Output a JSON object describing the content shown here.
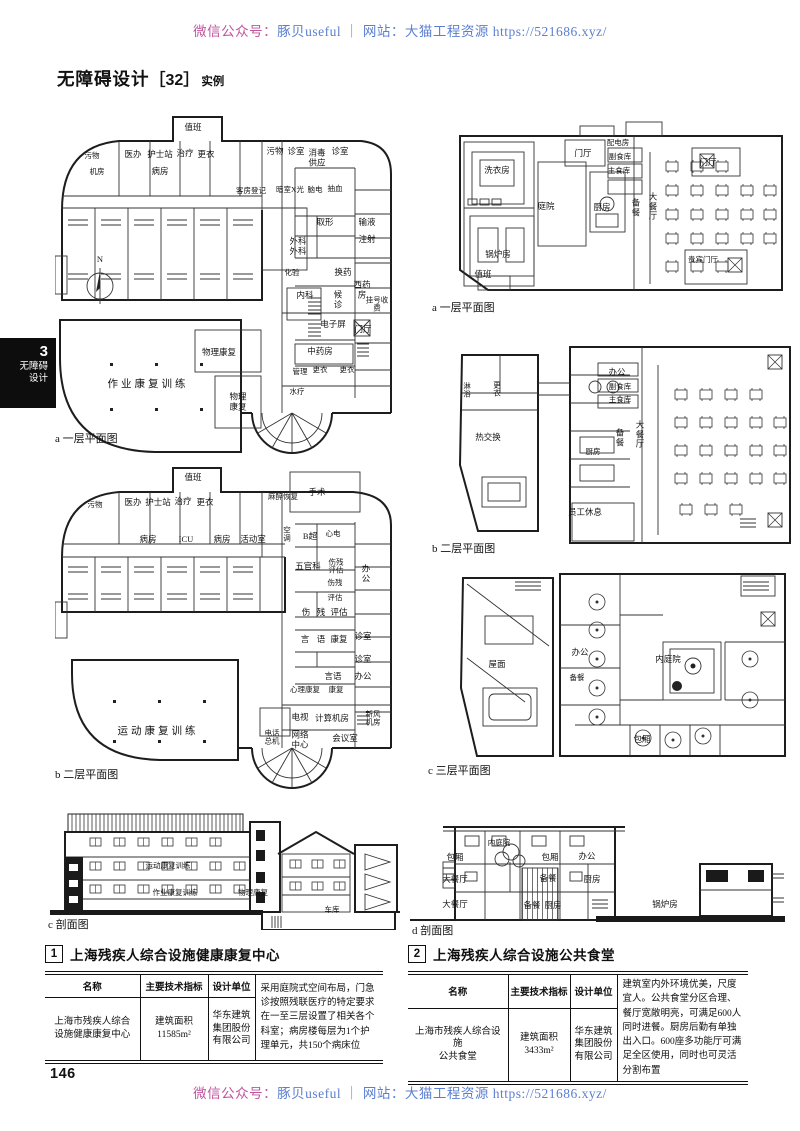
{
  "watermark": {
    "wechat_label": "微信公众号：",
    "wechat_name": "豚贝useful",
    "divider": "｜",
    "site_text": "网站：大猫工程资源 https://521686.xyz/",
    "magenta": "#c0559e",
    "blue": "#5b7fd0"
  },
  "title": {
    "main": "无障碍设计",
    "bracket": "［32］",
    "suffix": "实例"
  },
  "sidebar_tab": {
    "number": "3",
    "line1": "无障碍",
    "line2": "设计"
  },
  "page_number": "146",
  "figures": {
    "plan_a_left": {
      "caption": "a 一层平面图",
      "labels": [
        {
          "t": "值班",
          "x": 138,
          "y": 20
        },
        {
          "t": "污物",
          "x": 37,
          "y": 48,
          "s": 1
        },
        {
          "t": "机房",
          "x": 42,
          "y": 64,
          "s": 1
        },
        {
          "t": "医办",
          "x": 78,
          "y": 47
        },
        {
          "t": "护士站",
          "x": 105,
          "y": 47
        },
        {
          "t": "治疗",
          "x": 130,
          "y": 46
        },
        {
          "t": "更衣",
          "x": 151,
          "y": 47
        },
        {
          "t": "病房",
          "x": 105,
          "y": 64
        },
        {
          "t": "污物",
          "x": 220,
          "y": 44
        },
        {
          "t": "诊室",
          "x": 241,
          "y": 44
        },
        {
          "t": "消毒\n供应",
          "x": 262,
          "y": 50
        },
        {
          "t": "诊室",
          "x": 285,
          "y": 44
        },
        {
          "t": "客房登记",
          "x": 196,
          "y": 83,
          "s": 1
        },
        {
          "t": "暗室X光",
          "x": 235,
          "y": 82,
          "s": 1
        },
        {
          "t": "脑电",
          "x": 260,
          "y": 82,
          "s": 1
        },
        {
          "t": "抽血",
          "x": 280,
          "y": 81,
          "s": 1
        },
        {
          "t": "取形",
          "x": 270,
          "y": 115
        },
        {
          "t": "输液",
          "x": 312,
          "y": 115
        },
        {
          "t": "注射",
          "x": 312,
          "y": 132
        },
        {
          "t": "外科",
          "x": 243,
          "y": 134
        },
        {
          "t": "外科",
          "x": 243,
          "y": 144
        },
        {
          "t": "化验",
          "x": 237,
          "y": 165,
          "s": 1
        },
        {
          "t": "换药",
          "x": 288,
          "y": 165
        },
        {
          "t": "西药\n房",
          "x": 307,
          "y": 182
        },
        {
          "t": "挂号收费",
          "x": 322,
          "y": 197,
          "s": 1
        },
        {
          "t": "内科",
          "x": 250,
          "y": 188
        },
        {
          "t": "候\n诊",
          "x": 283,
          "y": 192
        },
        {
          "t": "电子屏",
          "x": 278,
          "y": 217
        },
        {
          "t": "门厅",
          "x": 308,
          "y": 222
        },
        {
          "t": "中药房",
          "x": 265,
          "y": 244
        },
        {
          "t": "管理",
          "x": 245,
          "y": 264,
          "s": 1
        },
        {
          "t": "更衣",
          "x": 265,
          "y": 262,
          "s": 1
        },
        {
          "t": "更衣",
          "x": 292,
          "y": 262,
          "s": 1
        },
        {
          "t": "水疗",
          "x": 242,
          "y": 284,
          "s": 1
        },
        {
          "t": "作业康复训练",
          "x": 93,
          "y": 277,
          "b": 1
        },
        {
          "t": "物理康复",
          "x": 164,
          "y": 245
        },
        {
          "t": "物理\n康复",
          "x": 183,
          "y": 294
        },
        {
          "t": "N",
          "x": 45,
          "y": 152
        }
      ]
    },
    "plan_b_left": {
      "caption": "b 二层平面图",
      "labels": [
        {
          "t": "值班",
          "x": 138,
          "y": 16
        },
        {
          "t": "污物",
          "x": 40,
          "y": 43,
          "s": 1
        },
        {
          "t": "医办",
          "x": 78,
          "y": 41
        },
        {
          "t": "护士站",
          "x": 103,
          "y": 41
        },
        {
          "t": "治疗",
          "x": 128,
          "y": 40
        },
        {
          "t": "更衣",
          "x": 150,
          "y": 41
        },
        {
          "t": "麻醉恢复",
          "x": 228,
          "y": 35,
          "s": 1
        },
        {
          "t": "手术",
          "x": 262,
          "y": 31
        },
        {
          "t": "病房",
          "x": 93,
          "y": 78
        },
        {
          "t": "ICU",
          "x": 131,
          "y": 78
        },
        {
          "t": "病房",
          "x": 167,
          "y": 78
        },
        {
          "t": "活动室",
          "x": 198,
          "y": 78
        },
        {
          "t": "空\n调",
          "x": 232,
          "y": 73,
          "s": 1
        },
        {
          "t": "B超",
          "x": 255,
          "y": 75
        },
        {
          "t": "心电",
          "x": 278,
          "y": 72,
          "s": 1
        },
        {
          "t": "五官科",
          "x": 253,
          "y": 105
        },
        {
          "t": "伤残\n评估",
          "x": 281,
          "y": 105,
          "s": 1
        },
        {
          "t": "办\n公",
          "x": 311,
          "y": 112
        },
        {
          "t": "伤残",
          "x": 280,
          "y": 121,
          "s": 1
        },
        {
          "t": "评估",
          "x": 280,
          "y": 136,
          "s": 1
        },
        {
          "t": "伤",
          "x": 251,
          "y": 151
        },
        {
          "t": "残",
          "x": 266,
          "y": 151
        },
        {
          "t": "评估",
          "x": 284,
          "y": 151
        },
        {
          "t": "言",
          "x": 250,
          "y": 178
        },
        {
          "t": "语",
          "x": 266,
          "y": 178
        },
        {
          "t": "康复",
          "x": 284,
          "y": 178
        },
        {
          "t": "诊室",
          "x": 308,
          "y": 175
        },
        {
          "t": "诊室",
          "x": 308,
          "y": 198
        },
        {
          "t": "言语",
          "x": 278,
          "y": 215
        },
        {
          "t": "办公",
          "x": 308,
          "y": 215
        },
        {
          "t": "心理康复",
          "x": 250,
          "y": 228,
          "s": 1
        },
        {
          "t": "康复",
          "x": 281,
          "y": 228,
          "s": 1
        },
        {
          "t": "电视",
          "x": 245,
          "y": 256
        },
        {
          "t": "计算机房",
          "x": 277,
          "y": 257
        },
        {
          "t": "新风\n机房",
          "x": 318,
          "y": 257,
          "s": 1
        },
        {
          "t": "电话\n总机",
          "x": 217,
          "y": 276,
          "s": 1
        },
        {
          "t": "网络\n中心",
          "x": 245,
          "y": 278
        },
        {
          "t": "会议室",
          "x": 290,
          "y": 277
        },
        {
          "t": "运动康复训练",
          "x": 103,
          "y": 270,
          "b": 1
        }
      ]
    },
    "section_c": {
      "caption": "c 剖面图",
      "labels": [
        {
          "t": "运动康复训练",
          "x": 118,
          "y": 64,
          "s": 1
        },
        {
          "t": "作业康复训练",
          "x": 125,
          "y": 91,
          "s": 1
        },
        {
          "t": "物理康复",
          "x": 203,
          "y": 91,
          "s": 1
        },
        {
          "t": "车库",
          "x": 282,
          "y": 108,
          "s": 1
        }
      ]
    },
    "plan_a_right": {
      "caption": "a 一层平面图",
      "labels": [
        {
          "t": "洗衣房",
          "x": 67,
          "y": 59
        },
        {
          "t": "庭院",
          "x": 116,
          "y": 95
        },
        {
          "t": "门厅",
          "x": 153,
          "y": 42
        },
        {
          "t": "配电房",
          "x": 188,
          "y": 31,
          "s": 1
        },
        {
          "t": "副食库",
          "x": 190,
          "y": 45,
          "s": 1
        },
        {
          "t": "主食库",
          "x": 189,
          "y": 59,
          "s": 1
        },
        {
          "t": "厨房",
          "x": 172,
          "y": 96
        },
        {
          "t": "备\n餐",
          "x": 206,
          "y": 96
        },
        {
          "t": "大\n餐\n厅",
          "x": 223,
          "y": 95
        },
        {
          "t": "门厅",
          "x": 278,
          "y": 51
        },
        {
          "t": "贵宾门厅",
          "x": 273,
          "y": 148,
          "s": 1
        },
        {
          "t": "锅炉房",
          "x": 68,
          "y": 143
        },
        {
          "t": "值班",
          "x": 53,
          "y": 163
        }
      ]
    },
    "plan_b_right": {
      "caption": "b 二层平面图",
      "labels": [
        {
          "t": "淋\n浴",
          "x": 37,
          "y": 56,
          "s": 1
        },
        {
          "t": "更\n衣",
          "x": 67,
          "y": 55,
          "s": 1
        },
        {
          "t": "热交换",
          "x": 58,
          "y": 103
        },
        {
          "t": "办公",
          "x": 187,
          "y": 38
        },
        {
          "t": "副食库",
          "x": 190,
          "y": 52,
          "s": 1
        },
        {
          "t": "主食库",
          "x": 190,
          "y": 65,
          "s": 1
        },
        {
          "t": "备\n餐",
          "x": 190,
          "y": 103
        },
        {
          "t": "大\n餐\n厅",
          "x": 210,
          "y": 100
        },
        {
          "t": "厨房",
          "x": 163,
          "y": 117,
          "s": 1
        },
        {
          "t": "员工休息",
          "x": 155,
          "y": 178
        }
      ]
    },
    "plan_c_right": {
      "caption": "c 三层平面图",
      "labels": [
        {
          "t": "屋面",
          "x": 72,
          "y": 105
        },
        {
          "t": "办公",
          "x": 155,
          "y": 93
        },
        {
          "t": "备餐",
          "x": 152,
          "y": 118,
          "s": 1
        },
        {
          "t": "内庭院",
          "x": 243,
          "y": 100
        },
        {
          "t": "包厢",
          "x": 217,
          "y": 180
        }
      ]
    },
    "section_d": {
      "caption": "d 剖面图",
      "labels": [
        {
          "t": "内庭院",
          "x": 89,
          "y": 41,
          "s": 1
        },
        {
          "t": "包厢",
          "x": 45,
          "y": 56
        },
        {
          "t": "包厢",
          "x": 140,
          "y": 56
        },
        {
          "t": "办公",
          "x": 177,
          "y": 55
        },
        {
          "t": "大餐厅",
          "x": 45,
          "y": 78
        },
        {
          "t": "备餐",
          "x": 138,
          "y": 77
        },
        {
          "t": "厨房",
          "x": 182,
          "y": 78
        },
        {
          "t": "大餐厅",
          "x": 45,
          "y": 103
        },
        {
          "t": "备餐",
          "x": 122,
          "y": 104
        },
        {
          "t": "厨房",
          "x": 143,
          "y": 104
        },
        {
          "t": "锅炉房",
          "x": 255,
          "y": 103
        }
      ]
    }
  },
  "tables": [
    {
      "num": "1",
      "title": "上海残疾人综合设施健康康复中心",
      "headers": [
        "名称",
        "主要技术指标",
        "设计单位"
      ],
      "row": {
        "name": "上海市残疾人综合\n设施健康康复中心",
        "tech": "建筑面积\n11585m²",
        "designer": "华东建筑\n集团股份\n有限公司",
        "desc": "采用庭院式空间布局，门急诊按照残联医疗的特定要求在一至三层设置了相关各个科室；病房楼每层为1个护理单元，共150个病床位"
      }
    },
    {
      "num": "2",
      "title": "上海残疾人综合设施公共食堂",
      "headers": [
        "名称",
        "主要技术指标",
        "设计单位"
      ],
      "row": {
        "name": "上海市残疾人综合设施\n公共食堂",
        "tech": "建筑面积\n3433m²",
        "designer": "华东建筑\n集团股份\n有限公司",
        "desc": "建筑室内外环境优美，尺度宜人。公共食堂分区合理、餐厅宽敞明亮，可满足600人同时进餐。厨房后勤有单独出入口。600座多功能厅可满足全区使用，同时也可灵活分割布置"
      }
    }
  ]
}
